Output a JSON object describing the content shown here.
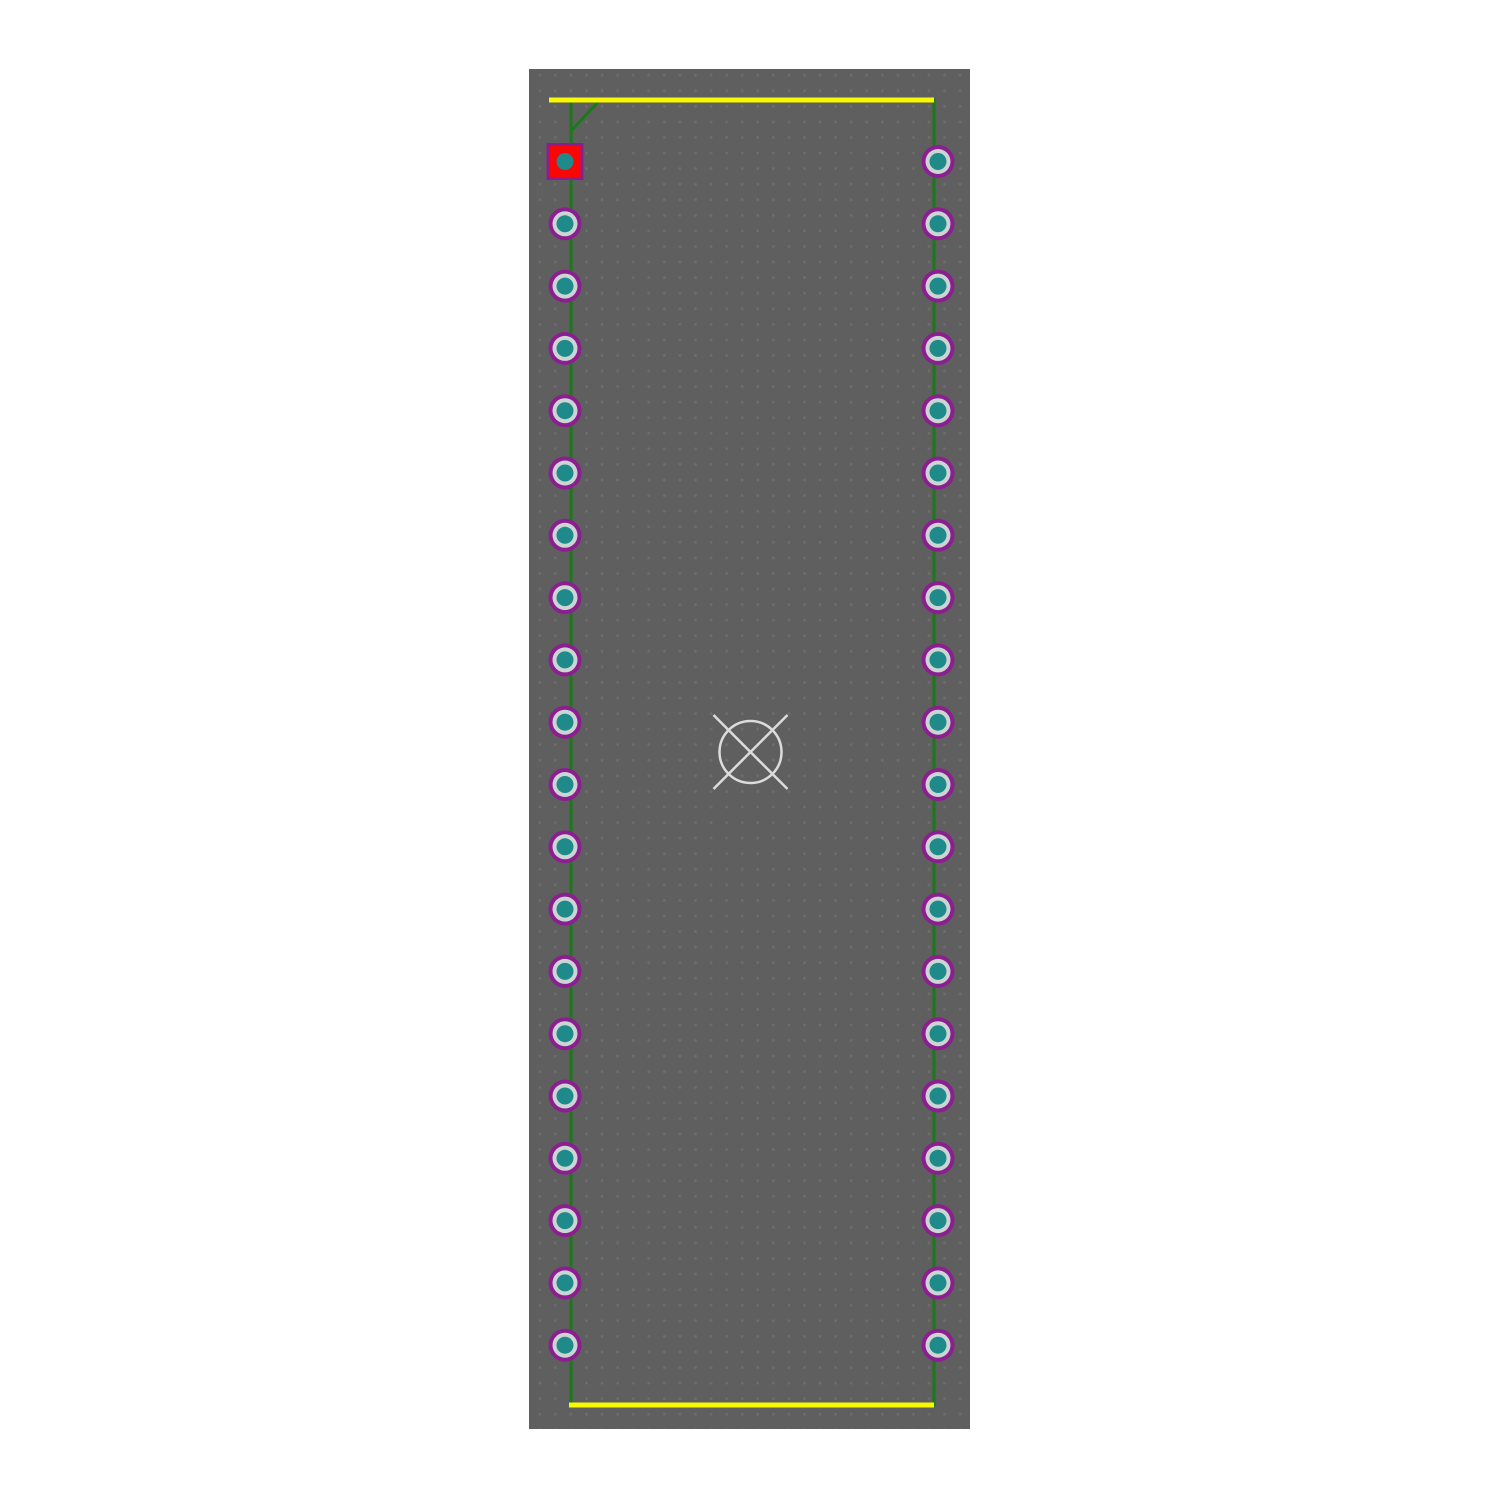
{
  "editor": {
    "page_background_color": "#ffffff",
    "board": {
      "x": 529,
      "y": 69,
      "width": 441,
      "height": 1360,
      "fill_color": "#5f5f5f",
      "grid_dot_color": "#6d6d6d",
      "grid_spacing": 15.57,
      "grid_dot_radius": 1.4
    },
    "silkscreen": {
      "color": "#f8f800",
      "stroke_width": 5,
      "top_line": {
        "x1": 549,
        "y1": 100,
        "x2": 934,
        "y2": 100
      },
      "bottom_line": {
        "x1": 569,
        "y1": 1405,
        "x2": 934,
        "y2": 1405
      }
    },
    "fab_outline": {
      "color": "#1a7a1a",
      "stroke_width": 3,
      "rect": {
        "left": 571,
        "top": 100,
        "right": 934,
        "bottom": 1405
      },
      "pin1_chamfer": {
        "x1": 600,
        "y1": 100,
        "x2": 571,
        "y2": 131
      }
    },
    "pads": {
      "first_y": 161.5,
      "pitch": 62.3,
      "count_per_column": 20,
      "columns": [
        {
          "name": "left",
          "x": 565,
          "first_pad_selected_square": true
        },
        {
          "name": "right",
          "x": 938,
          "first_pad_selected_square": false
        }
      ],
      "round_pad": {
        "outer_radius": 16.5,
        "ring_radius": 12.5,
        "hole_radius": 8.5,
        "outer_color": "#8b1f8f",
        "ring_color": "#ccd4d4",
        "hole_color": "#1f8a8a"
      },
      "selected_square_pad": {
        "size": 34,
        "border_width": 3,
        "border_color": "#8b1f8f",
        "fill_color": "#fa0606",
        "hole_radius": 8.5,
        "hole_color": "#1f8a8a"
      }
    },
    "origin_marker": {
      "x": 750.5,
      "y": 752,
      "radius": 31,
      "cross_extent": 37,
      "color": "#dcdcdc",
      "stroke_width": 2.5
    }
  }
}
